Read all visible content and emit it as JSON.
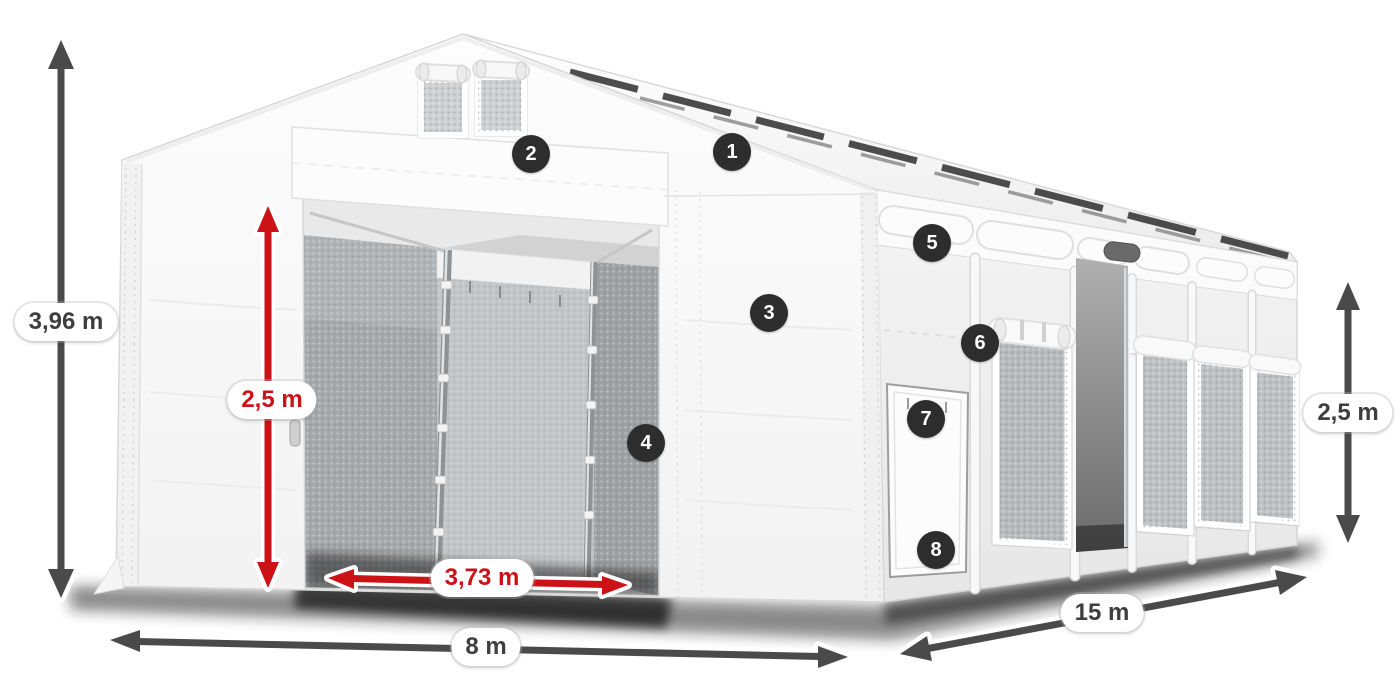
{
  "badges": [
    {
      "number": "1"
    },
    {
      "number": "2"
    },
    {
      "number": "3"
    },
    {
      "number": "4"
    },
    {
      "number": "5"
    },
    {
      "number": "6"
    },
    {
      "number": "7"
    },
    {
      "number": "8"
    }
  ],
  "dimensions": {
    "total_height": {
      "label": "3,96 m",
      "style": "gray"
    },
    "door_height": {
      "label": "2,5 m",
      "style": "red"
    },
    "door_width": {
      "label": "3,73 m",
      "style": "red"
    },
    "front_width": {
      "label": "8 m",
      "style": "gray"
    },
    "side_length": {
      "label": "15 m",
      "style": "gray"
    },
    "side_height": {
      "label": "2,5 m",
      "style": "gray"
    }
  },
  "colors": {
    "dimension_red": "#cc1117",
    "dimension_gray": "#4a4a4a",
    "badge_background": "#2d2d2d",
    "badge_text": "#ffffff",
    "canvas_background": "#ffffff"
  }
}
